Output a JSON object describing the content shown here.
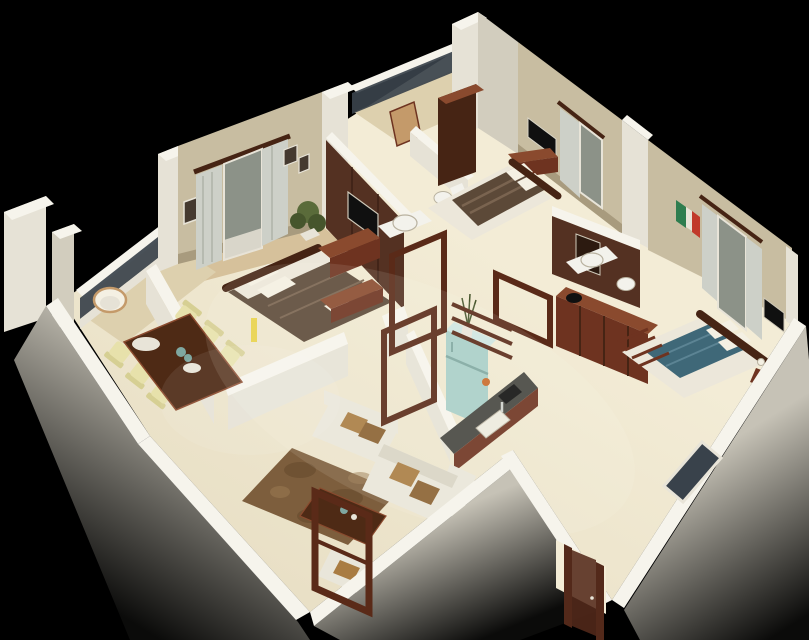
{
  "meta": {
    "description": "3D isometric render of an apartment floor plan viewed from above on a black background: master bedroom, two more bedrooms, two bathrooms, open living room with L-shaped sofa, dining table for six, kitchen with teal refrigerator, two balconies and an entrance door at the lower corner",
    "image_type": "3d-floor-plan-render"
  },
  "palette": {
    "bg": "#000000",
    "wallTop": "#f6f4ec",
    "wallLight": "#e6e2d6",
    "wallMid": "#d2cdbe",
    "wallShade": "#bdb6a4",
    "outerFaceTop": "#c6c2b6",
    "outerFaceBottom": "#0b0b0a",
    "floor": "#e9e0c6",
    "floorLight": "#f3ecd6",
    "floorTan": "#ddd0ae",
    "floorWood": "#d6c19b",
    "wallpaper": "#c8bda1",
    "skirt": "#a89b7e",
    "glass": "#39424b",
    "glassLight": "#8c9288",
    "curtain": "#cdd0c8",
    "curtainShade": "#aeb2a8",
    "woodDark": "#462414",
    "woodRed": "#6e3320",
    "woodRedLight": "#8a4a2e",
    "woodFrame": "#5a2a18",
    "bathTile": "#543122",
    "bedMaster": "#5c4938",
    "bedMasterStripe": "#7a6450",
    "bedBlue": "#3f6878",
    "bedBlueLight": "#5c8494",
    "mattress": "#ece7da",
    "pillow": "#f4f0e3",
    "sofa": "#e9e6da",
    "sofaShade": "#d8d4c5",
    "cushion": "#a97c42",
    "cushionDark": "#8a6030",
    "rug": "#7d5e3d",
    "rugDark": "#64492c",
    "chairCream": "#e7e1ab",
    "chairBack": "#d6cf93",
    "tableWood": "#4e2a15",
    "fridge": "#a9cfc8",
    "fridgeLight": "#cfe6e1",
    "fridgeDark": "#7fa8a1",
    "counter": "#44443f",
    "sink": "#eceade",
    "tv": "#101010",
    "frameDark": "#453a30",
    "artGreen": "#2f7d4f",
    "artRed": "#c13a2b",
    "artWhite": "#e8e4d8",
    "basin": "#f3f2ec",
    "plant": "#5a6b3a",
    "plantDark": "#46552c",
    "lampYellow": "#e8d24a",
    "doorWood": "#53291a",
    "chairWoodTan": "#c49a6a",
    "accentOrange": "#c96a2a"
  },
  "rooms": [
    {
      "id": "balcony-left",
      "items": [
        "glass railing",
        "round rattan chair"
      ]
    },
    {
      "id": "dining-area",
      "items": [
        "dark wood six-seat table",
        "cream chairs",
        "serving tray",
        "plates"
      ]
    },
    {
      "id": "master-bedroom",
      "items": [
        "double bed with taupe throw",
        "white pillows",
        "wall TV on dark panel",
        "TV cabinet",
        "foot bench",
        "potted plant",
        "curtained window"
      ]
    },
    {
      "id": "bathroom-1",
      "items": [
        "washbasin counter",
        "toilet",
        "dark brown tiled wall"
      ]
    },
    {
      "id": "balcony-top",
      "items": [
        "glass railing",
        "wooden chair"
      ]
    },
    {
      "id": "bedroom-2",
      "items": [
        "double bed with striped brown runner",
        "wall TV",
        "low TV cabinet",
        "tall dark wardrobe",
        "curtained window"
      ]
    },
    {
      "id": "bathroom-2",
      "items": [
        "washbasin counter",
        "mirror",
        "toilet",
        "dark brown tiled wall"
      ]
    },
    {
      "id": "bedroom-3",
      "items": [
        "double bed with teal-blue runner",
        "dark wood headboard",
        "sliding-door wardrobe",
        "bedside table with lamp",
        "framed art",
        "curtained balcony door",
        "wall TV"
      ]
    },
    {
      "id": "kitchen",
      "items": [
        "teal refrigerator with vase",
        "dark countertop with sink",
        "cooktop",
        "crockery unit"
      ]
    },
    {
      "id": "living-room",
      "items": [
        "L-shaped white sofa",
        "tan accent cushions",
        "single seater",
        "wood coffee table",
        "mottled brown rug",
        "open wood pergola frames"
      ]
    },
    {
      "id": "entrance",
      "items": [
        "open doorway with dark wood frame at lower corner"
      ]
    }
  ]
}
